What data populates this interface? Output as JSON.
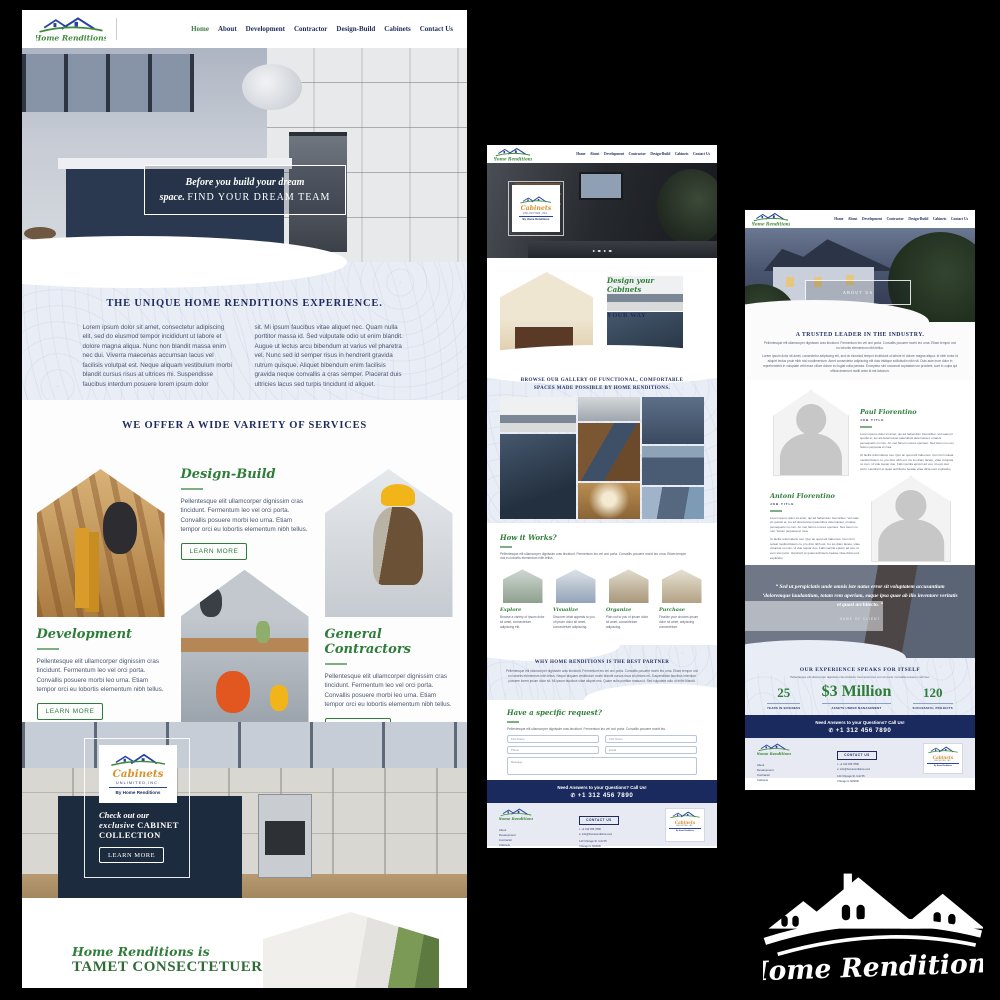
{
  "colors": {
    "navy": "#1e2b5c",
    "green": "#2f7d3a",
    "gold": "#d8922e",
    "bar_navy": "#1b2a5e",
    "light_blue": "#e9edf6"
  },
  "brand": {
    "name": "Home Renditions",
    "cabinets": {
      "script": "Cabinets",
      "unlimited": "UNLIMITED,INC.",
      "by": "By Home Renditions"
    }
  },
  "nav": {
    "items": [
      "Home",
      "About",
      "Development",
      "Contractor",
      "Design-Build",
      "Cabinets",
      "Contact Us"
    ]
  },
  "callbar": {
    "text": "Need Answers to your Questions? Call Us!",
    "phone": "+1 312 456 7890"
  },
  "footer": {
    "links": [
      "About",
      "Development",
      "Contractor",
      "Cabinets"
    ],
    "contact_label": "CONTACT US",
    "phone": "t: +1 312 456 7890",
    "email": "e: info@homerenditions.com",
    "address1": "123 Chicago St. Unit 55",
    "address2": "Chicago IL 600000"
  },
  "page1": {
    "hero": {
      "line1": "Before you build your dream",
      "line2_italic": "space.",
      "line2_caps": "FIND YOUR DREAM TEAM"
    },
    "experience": {
      "title": "THE UNIQUE HOME RENDITIONS EXPERIENCE.",
      "col1": "Lorem ipsum dolor sit amet, consectetur adipiscing elit, sed do eiusmod tempor incididunt ut labore et dolore magna aliqua. Nunc non blandit massa enim nec dui. Viverra maecenas accumsan lacus vel facilisis volutpat est. Neque aliquam vestibulum morbi blandit cursus risus at ultrices mi. Suspendisse faucibus interdum posuere lorem ipsum dolor",
      "col2": "sit. Mi ipsum faucibus vitae aliquet nec. Quam nulla porttitor massa id. Sed vulputate odio ut enim blandit. Augue ut lectus arcu bibendum at varius vel pharetra vel. Nunc sed id semper risus in hendrerit gravida rutrum quisque. Aliquet bibendum enim facilisis gravida neque convallis a cras semper. Placerat duis ultricies lacus sed turpis tincidunt id aliquet."
    },
    "services": {
      "title": "WE OFFER A WIDE VARIETY OF SERVICES",
      "learn_more": "LEARN MORE",
      "items": [
        {
          "name": "Development",
          "text": "Pellentesque elit ullamcorper dignissim cras tincidunt. Fermentum leo vel orci porta. Convallis posuere morbi leo urna. Etiam tempor orci eu lobortis elementum nibh tellus."
        },
        {
          "name": "Design-Build",
          "text": "Pellentesque elit ullamcorper dignissim cras tincidunt. Fermentum leo vel orci porta. Convallis posuere morbi leo urna. Etiam tempor orci eu lobortis elementum nibh tellus."
        },
        {
          "name": "General Contractors",
          "text": "Pellentesque elit ullamcorper dignissim cras tincidunt. Fermentum leo vel orci porta. Convallis posuere morbi leo urna. Etiam tempor orci eu lobortis elementum nibh tellus."
        }
      ]
    },
    "cabinet_banner": {
      "line1": "Check out our",
      "line2_italic": "exclusive",
      "line2_caps": "CABINET",
      "line3": "COLLECTION",
      "button": "LEARN MORE"
    },
    "bottom": {
      "line1": "Home Renditions is",
      "line2": "TAMET CONSECTETUER"
    }
  },
  "page2": {
    "design": {
      "title_script": "Design your Cabinets",
      "title_caps": "YOUR WAY",
      "p1": "Lorem ipsum dolor sit amet, qui ad habendum forensibus. Vel suas pri quodsi et, ius ad deterruisset patentibus deterruisset, ornatus persequeris cu cum. An mel harum omnes oportere. Nec lorem no mei. Solum perpetua et mea.",
      "p2": "Ut facilis reformidans mei. Quo an quod elit habemus. Cum ferri soleat mediocritatem cu, pro dico nibh est. Cu ius diam facete, vitae voluptua no cum, id vide loquar duo. Falli mentita epicuri ad usu, id eum stet purto."
    },
    "gallery": {
      "title": "BROWSE OUR GALLERY OF FUNCTIONAL, COMFORTABLE SPACES MADE POSSIBLE BY HOME RENDITIONS."
    },
    "how": {
      "title": "How it Works?",
      "intro": "Pellentesque elit ullamcorper dignissim cras tincidunt. Fermentum leo vel orci porta. Convallis posuere morbi leo urna. Etiam tempor orci eu lobortis elementum nibh tellus.",
      "steps": [
        {
          "name": "Explore",
          "text": "Browse a variety of ipsum dolor sit amet, consectetuer adipiscing elit."
        },
        {
          "name": "Visualize",
          "text": "Discover what appeals to you of ipsum dolor sit amet, consectetuer adipiscing."
        },
        {
          "name": "Organize",
          "text": "Plan out to you of ipsum dolor sit amet, consectetuer adipiscing."
        },
        {
          "name": "Purchase",
          "text": "Finalize your choices ipsum dolor sit amet, adipiscing consectetuer."
        }
      ]
    },
    "why": {
      "title": "WHY HOME RENDITIONS IS THE BEST PARTNER",
      "text": "Pellentesque elit ullamcorper dignissim cras tincidunt. Fermentum leo vel orci porta. Convallis posuere morbi leo urna. Etiam tempor orci eu lobortis elementum nibh tellus. Neque aliquam vestibulum morbi blandit cursus risus at ultrices mi. Suspendisse faucibus interdum posuere lorem ipsum dolor sit. Mi ipsum faucibus vitae aliquet nec. Quam nulla porttitor massa id. Sed vulputate odio ut enim blandit."
    },
    "request": {
      "title": "Have a specific request?",
      "text": "Pellentesque elit ullamcorper dignissim cras tincidunt. Fermentum leo vel orci porta. Convallis posuere morbi leo.",
      "fields": {
        "field1": "First Name",
        "field2": "First Name",
        "phone": "Phone",
        "email": "Email",
        "message": "Message"
      },
      "button": "GET IN TOUCH"
    }
  },
  "page3": {
    "hero_label": "ABOUT US",
    "trusted": {
      "title": "A TRUSTED LEADER IN THE INDUSTRY.",
      "p1": "Pellentesque elit ullamcorper dignissim cras tincidunt. Fermentum leo vel orci porta. Convallis posuere morbi leo urna. Etiam tempor orci eu lobortis elementum nibh tellus.",
      "p2": "Lorem ipsum dolor sit amet, consectetur adipiscing elit, sed do eiusmod tempor incididunt ut labore et dolore magna aliqua. Id nibh tortor id aliquet lectus proin nibh nisl condimentum. Amet consectetur adipiscing elit duis tristique sollicitudin nibh sit. Duis aute irure dolor in reprehenderit in voluptate velit esse cillum dolore eu fugiat nulla pariatur. Excepteur sint occaecat cupidatat non proident, sunt in culpa qui officia deserunt mollit anim id est laborum."
    },
    "team": [
      {
        "name": "Paul Fiorentino",
        "title": "JOB TITLE",
        "p1": "Lorem ipsum dolor sit amet, qui ad habendum forensibus. Vel suas pri quodsi et, ius ad deterruisset patentibus deterruisset, ornatus persequeris cu cum. An mel harum omnes oportere. Nec lorem no mei. Solum perpetua et mea.",
        "p2": "Ut facilis reformidans mei. Quo an quod elit habemus. Cum ferri soleat mediocritatem cu, pro dico nibh est. Cu ius diam facete, vitae voluptua no cum, id vide loquar duo. Falli mentita epicuri ad usu, id eum stet purto. Hendrerit et quasi architecto beatae vitae dicta sunt explicabo."
      },
      {
        "name": "Antoni Fiorentino",
        "title": "JOB TITLE",
        "p1": "Lorem ipsum dolor sit amet, qui ad habendum forensibus. Vel suas pri quodsi et, ius ad deterruisset patentibus deterruisset, ornatus persequeris cu cum. An mel harum omnes oportere. Nec lorem no mei. Solum perpetua et mea.",
        "p2": "Ut facilis reformidans mei. Quo an quod elit habemus. Cum ferri soleat mediocritatem cu, pro dico nibh est. Cu ius diam facete, vitae voluptua no cum, id vide loquar duo. Falli mentita epicuri ad usu, id eum stet purto. Hendrerit et quasi architecto beatae vitae dicta sunt explicabo."
      }
    ],
    "quote": {
      "text": "“ Sed ut perspiciatis unde omnis iste natus error sit voluptatem accusantium ‘doloremque laudantium, totam rem aperiam, eaque ipsa quae ab illo inventore veritatis et quasi architecto. ”",
      "client": "NAME OF CLIENT"
    },
    "stats": {
      "title": "OUR EXPERIENCE SPEAKS FOR ITSELF",
      "subtitle": "Pellentesque elit ullamcorper dignissim cras tincidunt. Fermentum leo vel orci porta. Convallis posuere morbi leo.",
      "items": [
        {
          "value": "25",
          "label": "YEARS IN BUSINESS"
        },
        {
          "value": "$3 Million",
          "label": "ASSETS UNDER MANAGEMENT"
        },
        {
          "value": "120",
          "label": "SUCCESSFUL PROJECTS"
        }
      ]
    }
  }
}
